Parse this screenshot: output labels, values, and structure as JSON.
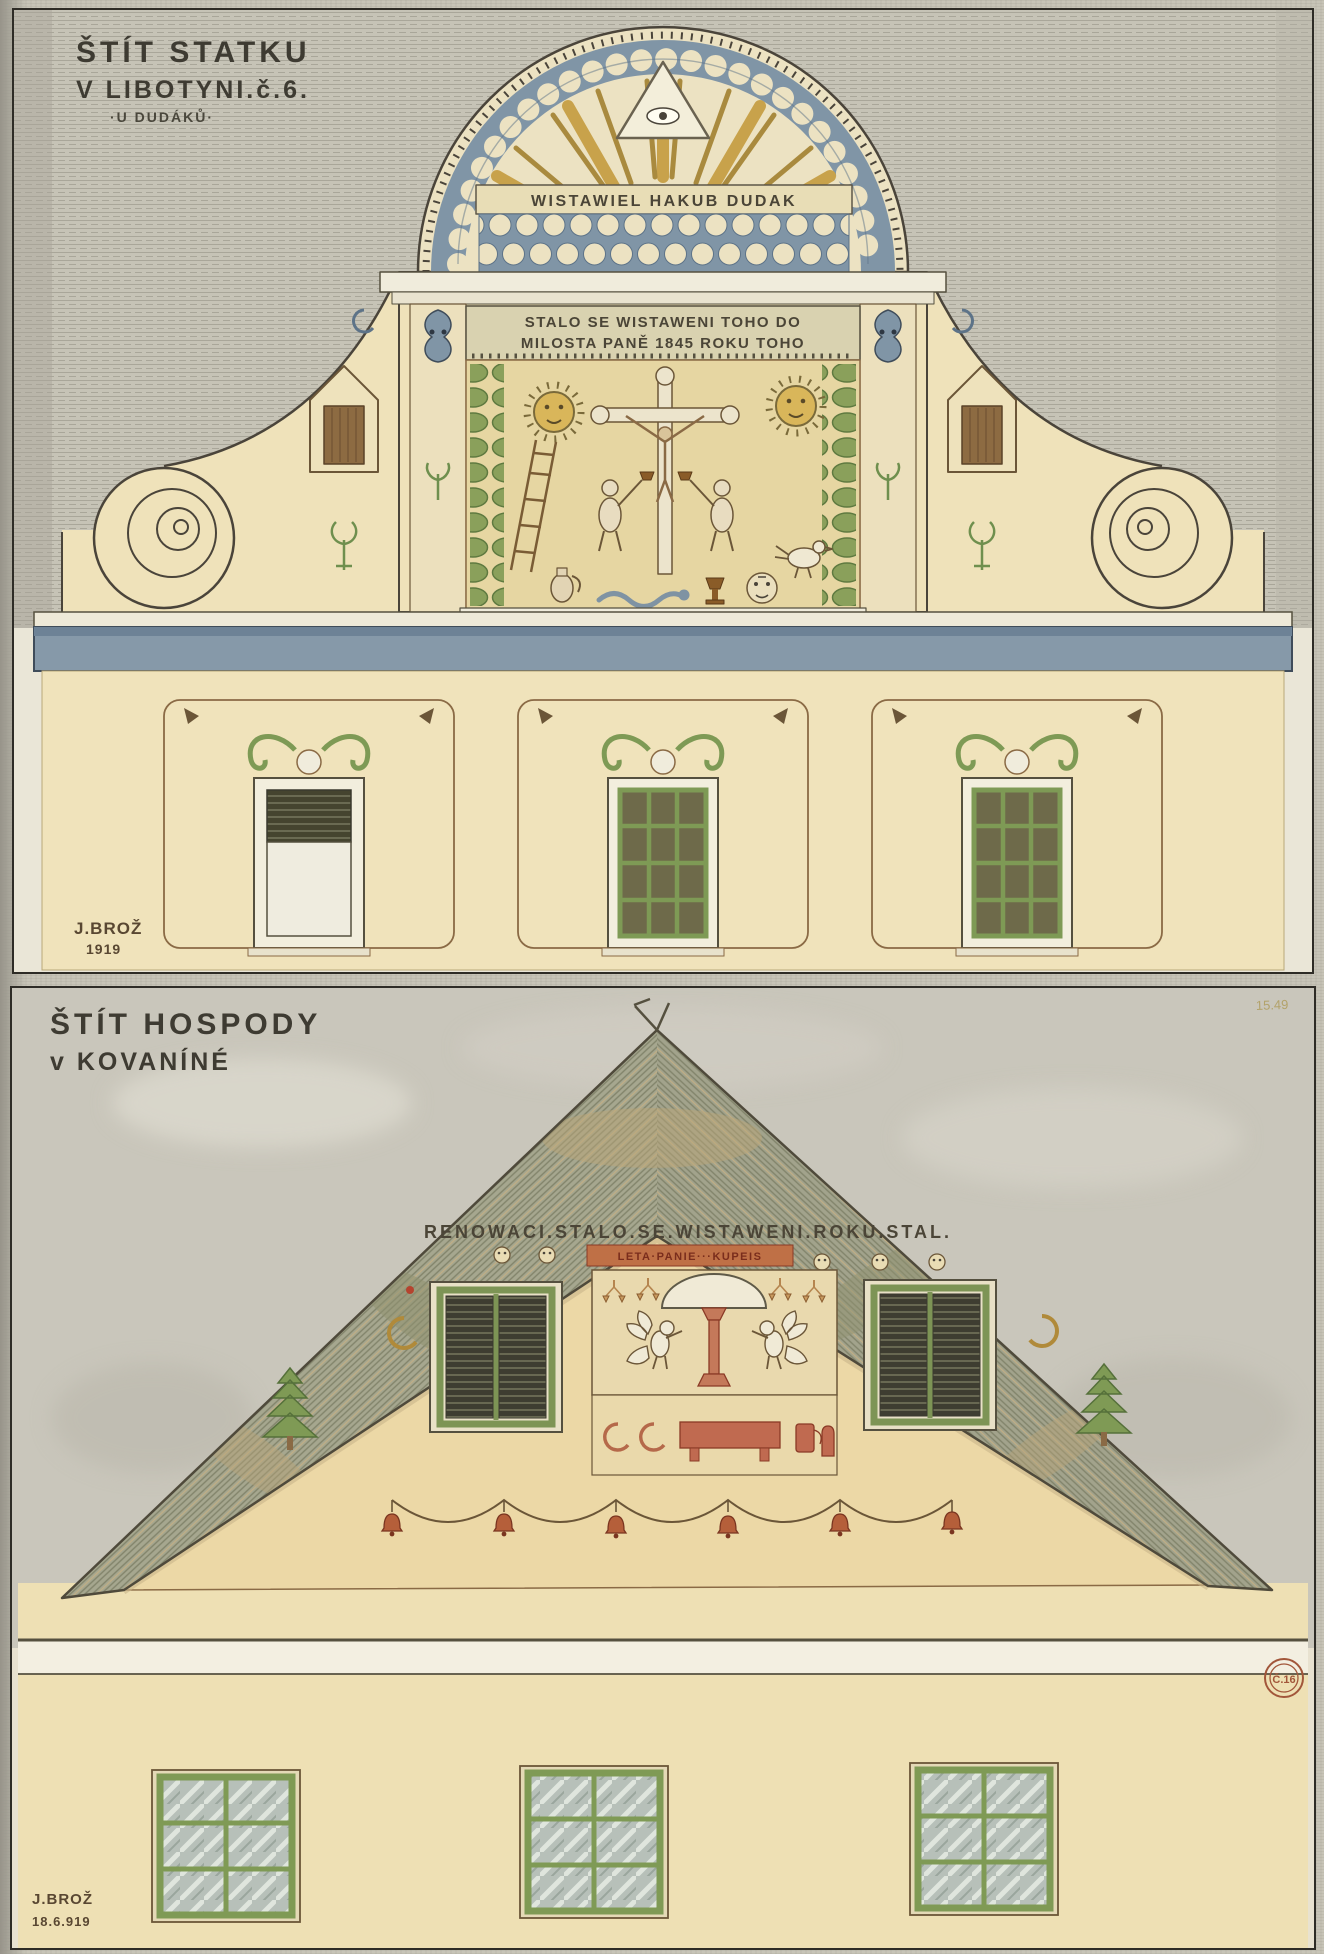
{
  "plate1": {
    "caption": {
      "line1": "ŠTÍT STATKU",
      "line2": "V LIBOTYNI.č.6.",
      "line3": "·U DUDÁKŮ·"
    },
    "arch_inscription": "WISTAWIEL HAKUB DUDAK",
    "date_band": {
      "line1": "STALO SE WISTAWENI TOHO DO",
      "line2": "MILOSTA PANĚ 1845 ROKU TOHO"
    },
    "signature": {
      "name": "J.BROŽ",
      "year": "1919"
    }
  },
  "plate2": {
    "caption": {
      "line1": "ŠTÍT HOSPODY",
      "line2": "v KOVANÍNÉ"
    },
    "corner_number": "15.49",
    "gable_inscription": "RENOWACI.STALO.SE.WISTAWENI.ROKU.STAL.",
    "red_inscription": "LETA·PANIE···KUPEIS",
    "stamp": "Č.16",
    "signature": {
      "name": "J.BROŽ",
      "date": "18.6.919"
    }
  },
  "colors": {
    "accent_blue": "#8095a6",
    "wall_cream": "#f0e3bb",
    "leaf_green": "#7e9a55",
    "terracotta": "#bf6a4a",
    "scan_gray": "#c7c4b7"
  }
}
